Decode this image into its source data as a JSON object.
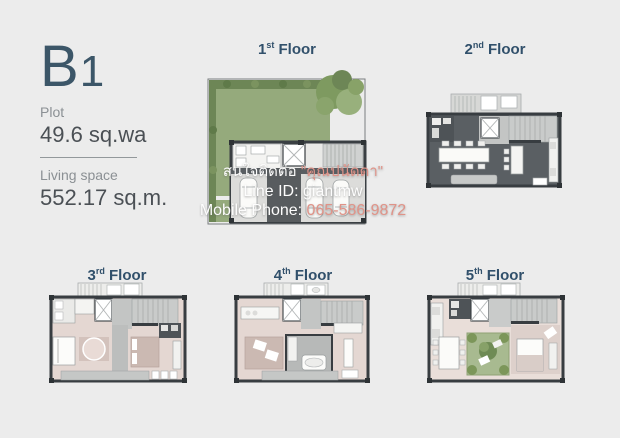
{
  "info": {
    "model_letter": "B",
    "model_digit": "1",
    "plot_label": "Plot",
    "plot_value": "49.6 sq.wa",
    "living_label": "Living space",
    "living_value": "552.17 sq.m."
  },
  "floors": [
    {
      "number": "1",
      "ordinal": "st",
      "word": "Floor"
    },
    {
      "number": "2",
      "ordinal": "nd",
      "word": "Floor"
    },
    {
      "number": "3",
      "ordinal": "rd",
      "word": "Floor"
    },
    {
      "number": "4",
      "ordinal": "th",
      "word": "Floor"
    },
    {
      "number": "5",
      "ordinal": "th",
      "word": "Floor"
    }
  ],
  "watermark": {
    "contact_prefix": "สนใจติดต่อ ",
    "contact_name": "\"คุณปนัดดา\"",
    "line_id": "Line ID: giantmw",
    "phone_label": "Mobile Phone: ",
    "phone_number": "065-586-9872"
  },
  "colors": {
    "background": "#ececec",
    "heading_text": "#3c5668",
    "floor_label_text": "#31506b",
    "muted_text": "#8b9094",
    "value_text": "#4b5055",
    "wall_dark": "#3a3f43",
    "garden_green": "#95aa7c",
    "hedge_green": "#6d8656",
    "courtyard_green": "#a8ba90",
    "dark_floor": "#5a5f63",
    "garage_floor": "#dcdcda",
    "terrace_gray": "#c9cbca",
    "bedroom_pink": "#e4d7d2",
    "watermark_text": "#fdfdfd",
    "watermark_phone": "#e09388"
  }
}
